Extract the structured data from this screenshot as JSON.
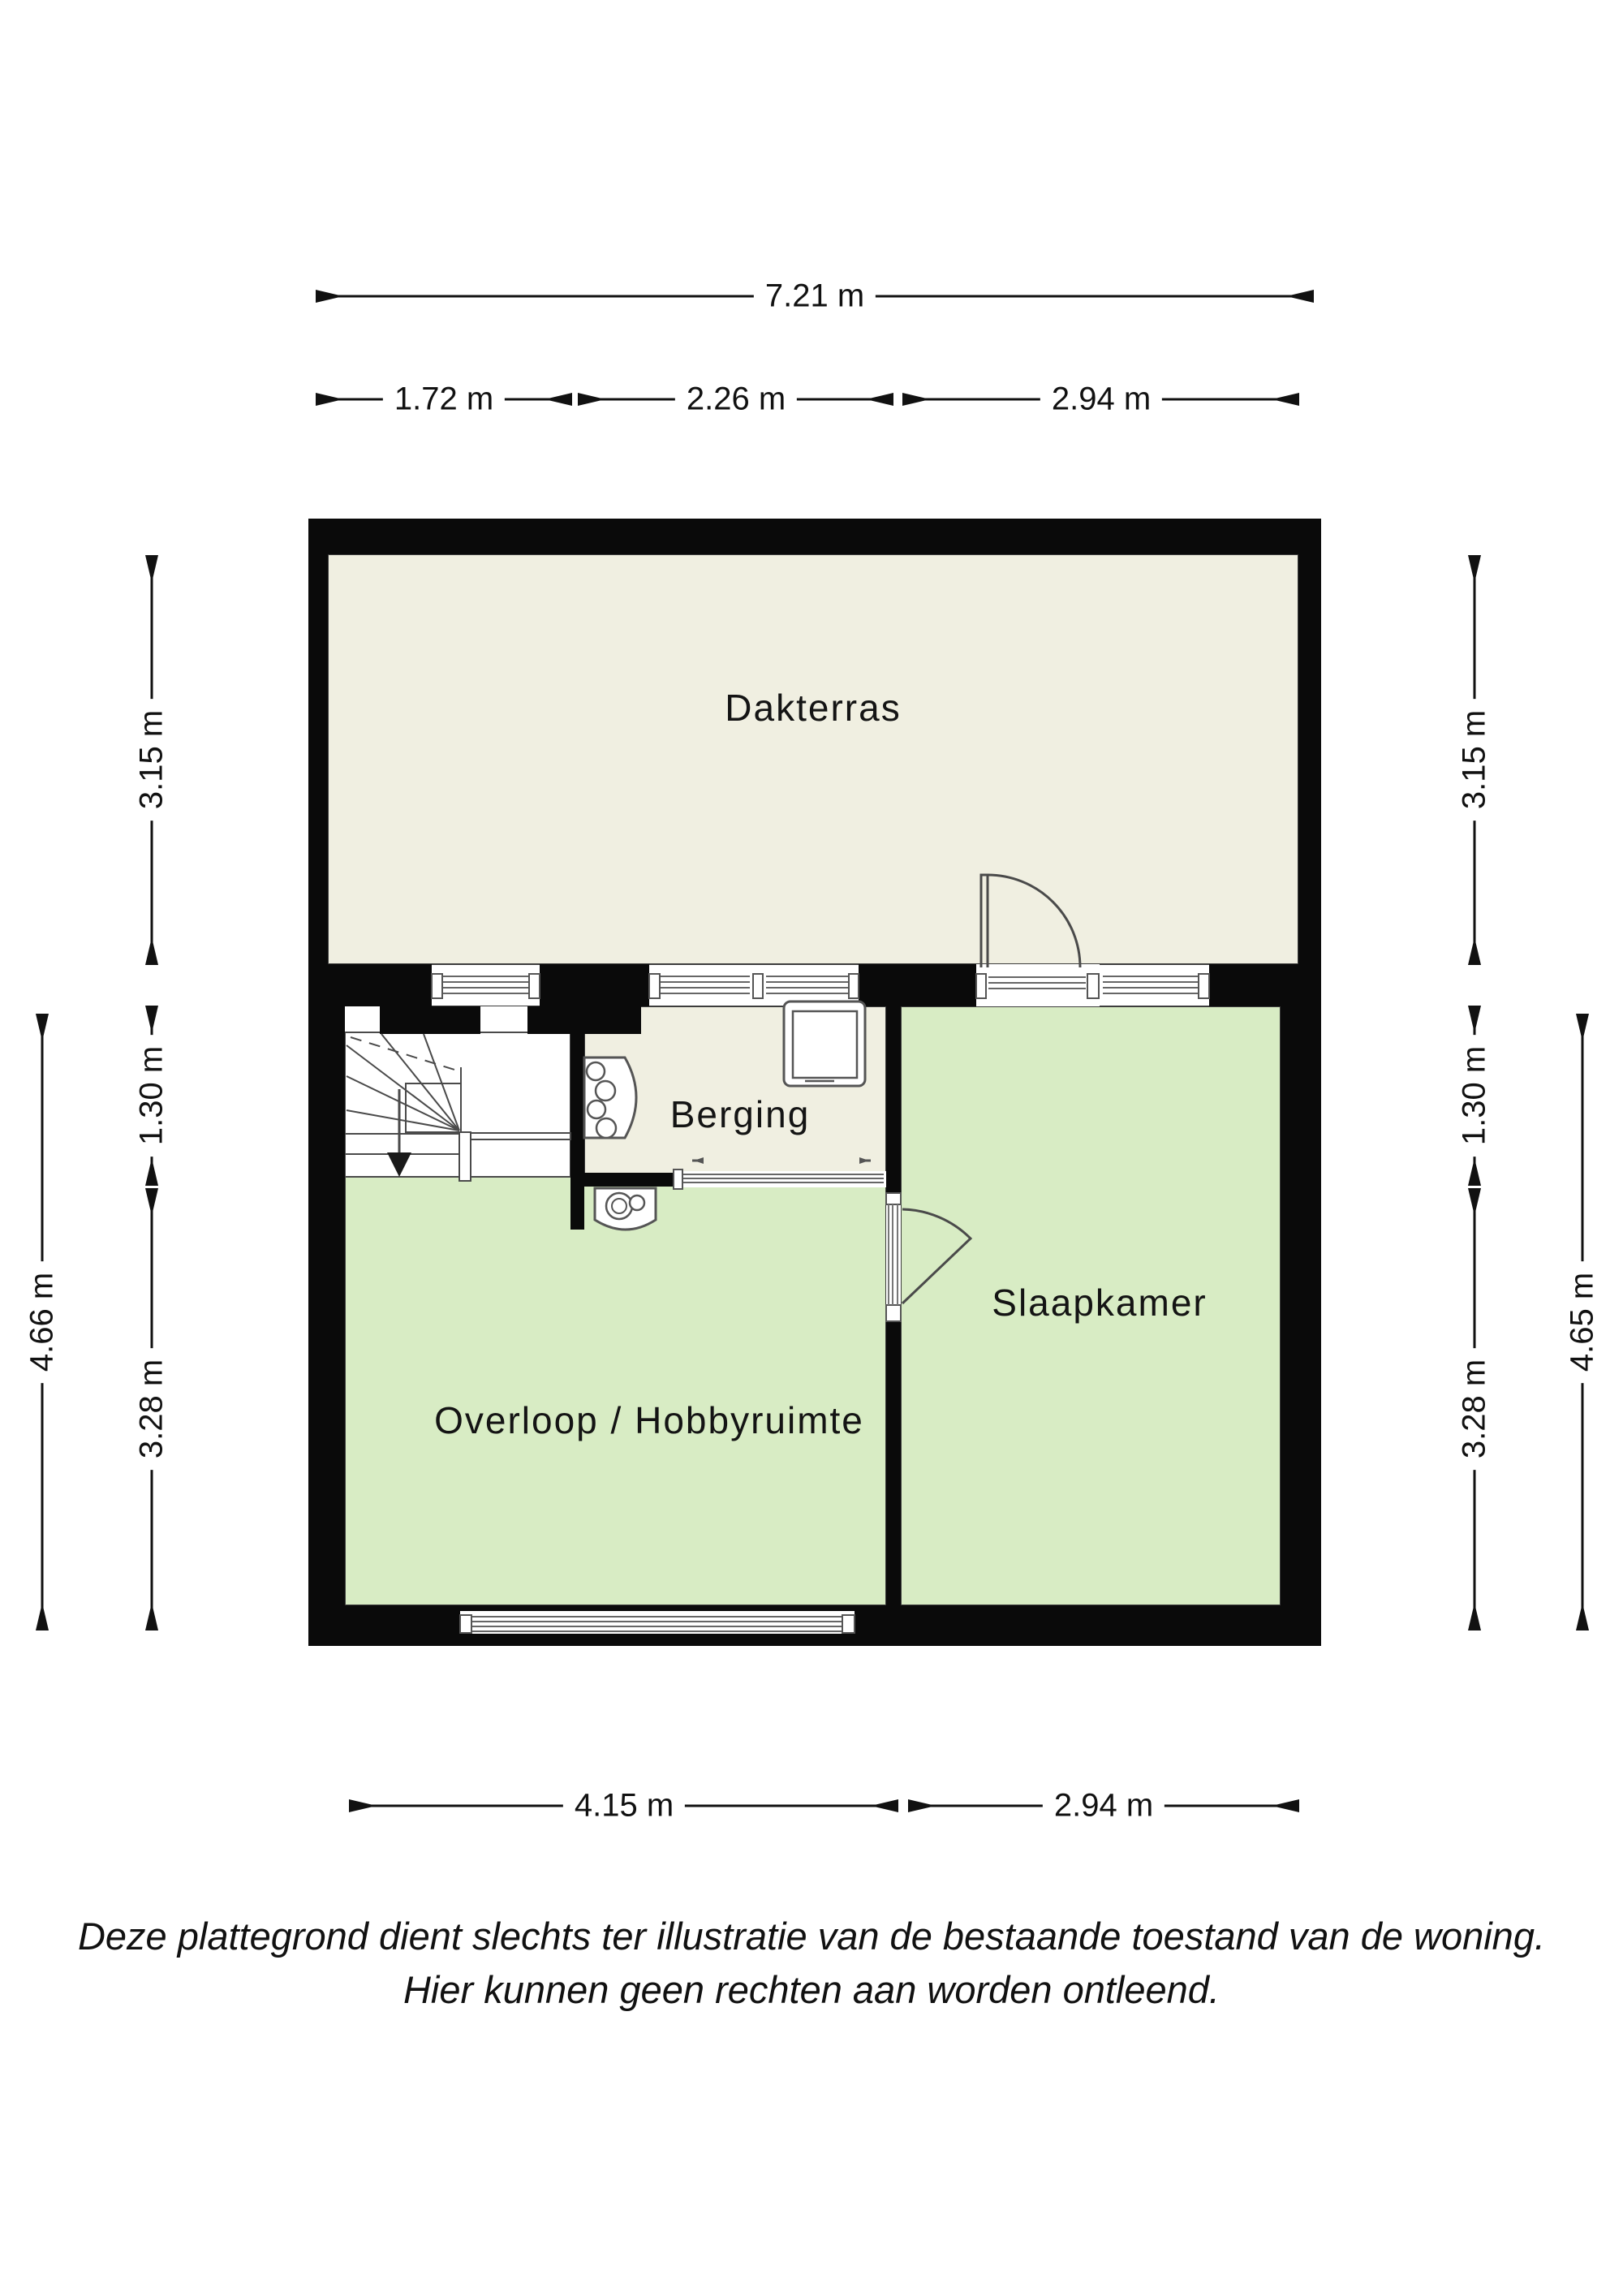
{
  "rooms": [
    {
      "id": "dakterras",
      "label": "Dakterras"
    },
    {
      "id": "berging",
      "label": "Berging"
    },
    {
      "id": "slaapkamer",
      "label": "Slaapkamer"
    },
    {
      "id": "overloop",
      "label": "Overloop / Hobbyruimte"
    }
  ],
  "dimensions": {
    "top_total": "7.21 m",
    "top_segments": [
      "1.72 m",
      "2.26 m",
      "2.94 m"
    ],
    "bottom_segments": [
      "4.15 m",
      "2.94 m"
    ],
    "left": {
      "terrace": "3.15 m",
      "middle": "1.30 m",
      "lower": "3.28 m",
      "total": "4.66 m"
    },
    "right": {
      "terrace": "3.15 m",
      "middle": "1.30 m",
      "lower": "3.28 m",
      "total": "4.65 m"
    }
  },
  "disclaimer": {
    "line1": "Deze plattegrond dient slechts ter illustratie van de bestaande toestand van de woning.",
    "line2": "Hier kunnen geen rechten aan worden ontleend."
  },
  "colors": {
    "wall": "#0a0a0a",
    "terrace_floor": "#f0efe1",
    "room_floor": "#d8ecc4",
    "outline": "#3c3c3c",
    "background": "#ffffff"
  }
}
